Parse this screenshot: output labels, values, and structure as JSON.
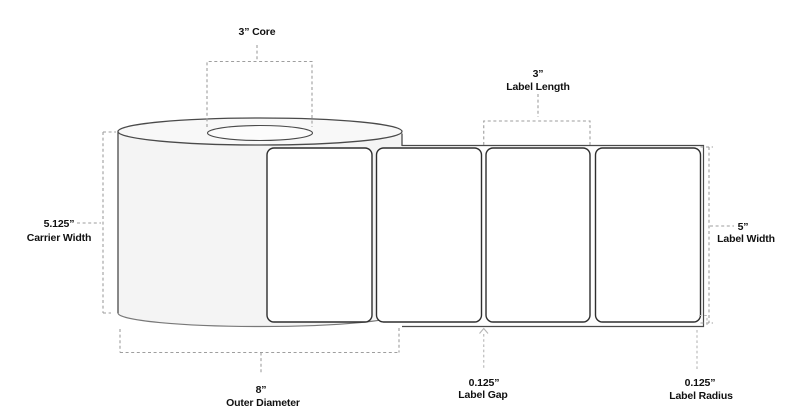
{
  "callouts": {
    "core": {
      "line1": "3” Core"
    },
    "label_length": {
      "line1": "3”",
      "line2": "Label Length"
    },
    "carrier_width": {
      "line1": "5.125”",
      "line2": "Carrier Width"
    },
    "label_width": {
      "line1": "5”",
      "line2": "Label Width"
    },
    "outer_diameter": {
      "line1": "8”",
      "line2": "Outer Diameter"
    },
    "label_gap": {
      "line1": "0.125”",
      "line2": "Label Gap"
    },
    "label_radius": {
      "line1": "0.125”",
      "line2": "Label Radius"
    }
  },
  "roll": {
    "visible_labels": 4
  },
  "colors": {
    "background": "#ffffff",
    "text": "#111111",
    "outline": "#4a4a4a",
    "label-outline": "#2e2e2e",
    "dash": "#9e9e9e",
    "dash-light": "#b6b6b6",
    "roll-face": "#f4f4f4",
    "roll-top": "#f8f8f8",
    "core-fill": "#fcfcfc",
    "liner-fill": "#fdfdfd",
    "label-fill": "#ffffff"
  }
}
